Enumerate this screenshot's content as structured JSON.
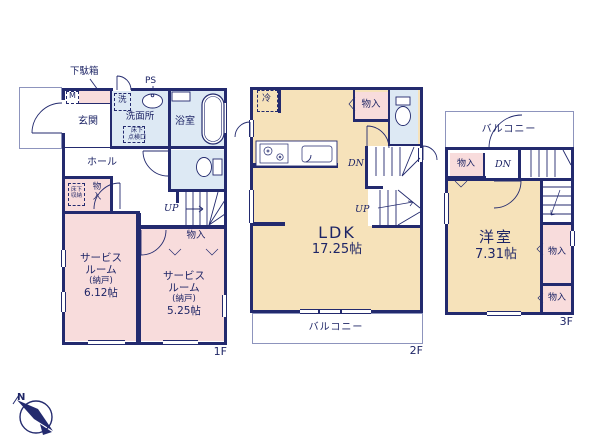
{
  "document_type": "floor-plan",
  "colors": {
    "wall": "#232a6e",
    "text": "#1e2566",
    "room_pink": "#f8dcdc",
    "room_blue": "#dde9f4",
    "room_cream": "#f6e2ba"
  },
  "compass": {
    "north": "N"
  },
  "floor1": {
    "floor_label": "1F",
    "getabako": "下駄箱",
    "meter": "M",
    "genkan": "玄関",
    "washer": "洗",
    "ps": "PS",
    "senmenjo": "洗面所",
    "tenkenko_l1": "床下",
    "tenkenko_l2": "点検口",
    "bathroom": "浴室",
    "hall": "ホール",
    "yukashita_l1": "床下",
    "yukashita_l2": "収納",
    "closet_hall_l1": "物",
    "closet_hall_l2": "入",
    "up": "UP",
    "closet": "物入",
    "service1_l1": "サービス",
    "service1_l2": "ルーム",
    "service1_l3": "(納戸)",
    "service1_l4": "6.12帖",
    "service2_l1": "サービス",
    "service2_l2": "ルーム",
    "service2_l3": "(納戸)",
    "service2_l4": "5.25帖"
  },
  "floor2": {
    "floor_label": "2F",
    "fridge": "冷",
    "closet": "物入",
    "dn": "DN",
    "up": "UP",
    "ldk": "LDK",
    "ldk_size": "17.25帖",
    "balcony": "バルコニー"
  },
  "floor3": {
    "floor_label": "3F",
    "balcony": "バルコニー",
    "closet_top": "物入",
    "dn": "DN",
    "room": "洋室",
    "room_size": "7.31帖",
    "closet_mid": "物入",
    "closet_bottom": "物入"
  }
}
